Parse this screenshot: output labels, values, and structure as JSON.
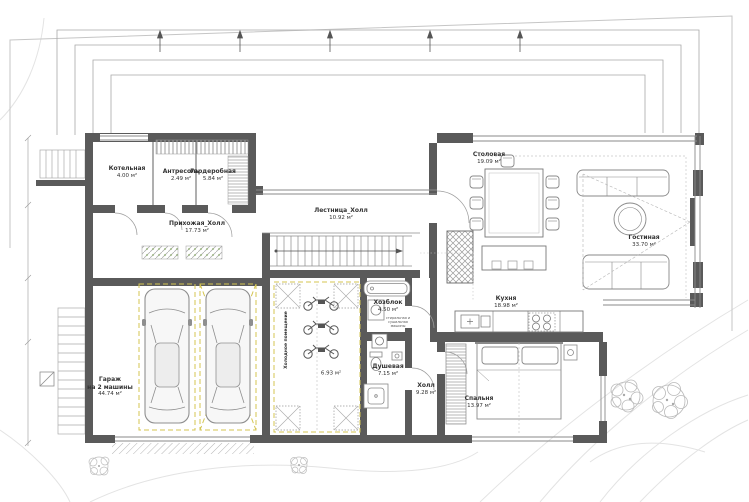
{
  "plan": {
    "rooms": {
      "boiler": {
        "name": "Котельная",
        "area": "4.00 м²"
      },
      "mezzanine": {
        "name": "Антресоль",
        "area": "2.49 м²"
      },
      "wardrobe": {
        "name": "Гардеробная",
        "area": "5.84 м²"
      },
      "entry_hall": {
        "name": "Прихожая_Холл",
        "area": "17.73 м²"
      },
      "stair_hall": {
        "name": "Лестница_Холл",
        "area": "10.92 м²"
      },
      "dining": {
        "name": "Столовая",
        "area": "19.09 м²"
      },
      "living": {
        "name": "Гостиная",
        "area": "33.70 м²"
      },
      "kitchen": {
        "name": "Кухня",
        "area": "18.98 м²"
      },
      "bedroom": {
        "name": "Спальня",
        "area": "13.97 м²"
      },
      "hall": {
        "name": "Холл",
        "area": "9.28 м²"
      },
      "shower": {
        "name": "Душевая",
        "area": "7.15 м²"
      },
      "utility": {
        "name": "Хозблок",
        "area": "4.50 м²"
      },
      "garage": {
        "name": "Гараж",
        "name2": "на 2 машины",
        "area": "44.74 м²"
      },
      "cold_store": {
        "name": "Холодное помещение",
        "area": "6.93 м²"
      }
    },
    "annotations": {
      "machines": "стиральная и сушильная машины"
    },
    "colors": {
      "wall": "#5a5a5a",
      "marking": "#d4c552",
      "contour": "#e3e3e3",
      "text": "#333333"
    }
  }
}
